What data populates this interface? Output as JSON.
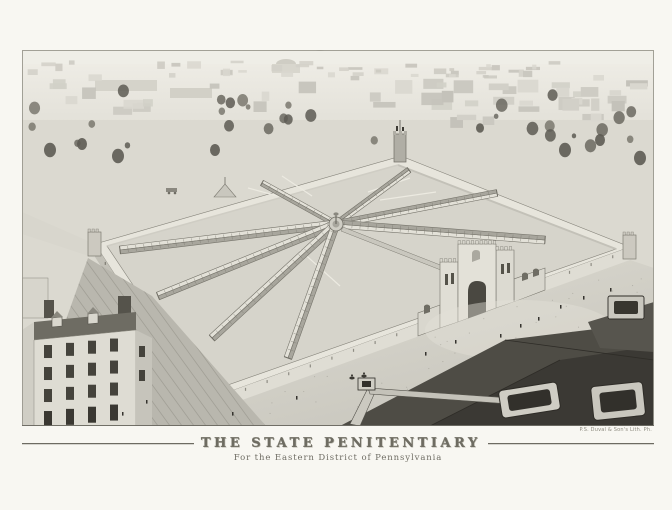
{
  "print": {
    "title": "THE STATE PENITENTIARY",
    "subtitle": "For the Eastern District of Pennsylvania",
    "printer_credit": "P.S. Duval & Son's Lith. Ph.",
    "colors": {
      "paper": "#f8f7f2",
      "plate_background": "#e9e7df",
      "wall_light_face": "#dfddd4",
      "wall_shaded_face": "#c2c0b7",
      "yard": "#d6d4cb",
      "roof_dark": "#4c4a43",
      "ink_dark": "#35332e",
      "title_ink": "#6e6c62",
      "rule_ink": "#6d6b62"
    }
  }
}
